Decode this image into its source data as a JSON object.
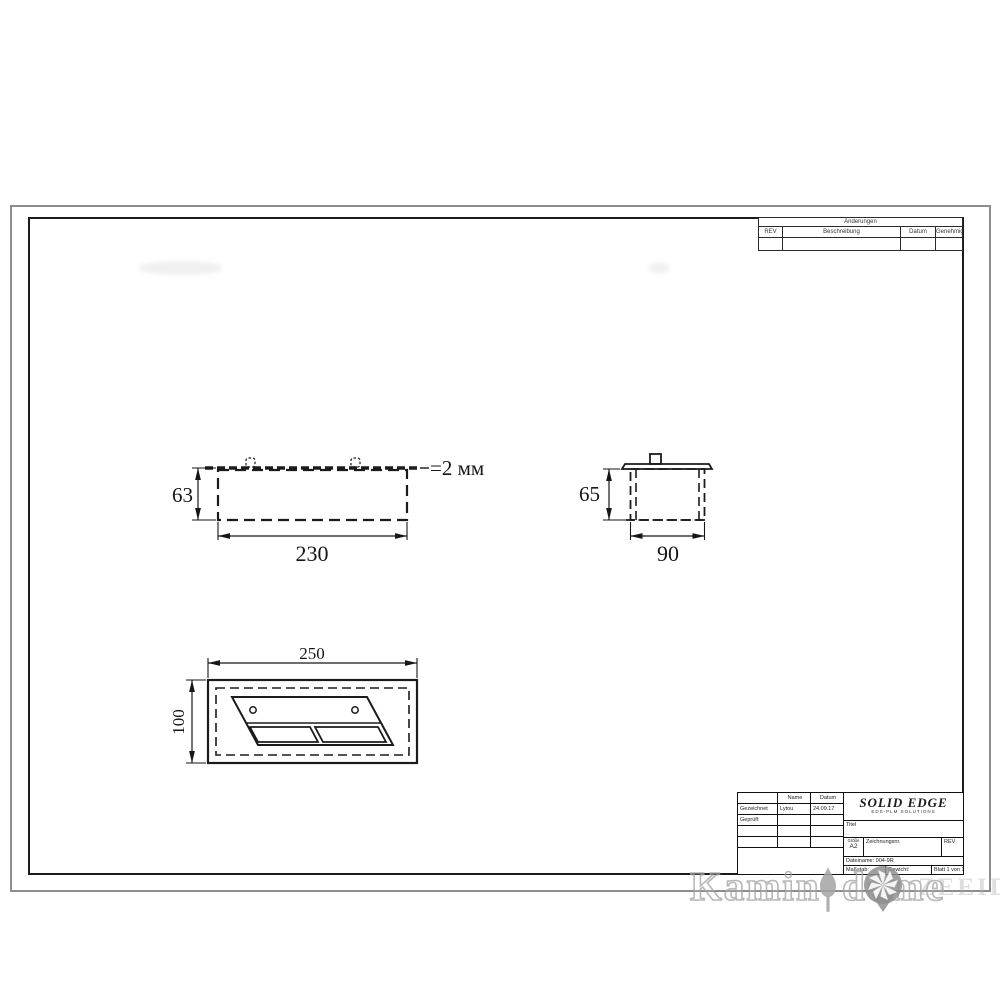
{
  "sheet": {
    "background": "#ffffff",
    "outer_border_color": "#8d8d8d",
    "frame_color": "#1b1b1b"
  },
  "revision_table": {
    "title": "Änderungen",
    "columns": [
      "REV",
      "Beschreibung",
      "Datum",
      "Genehmigt"
    ]
  },
  "views": {
    "front": {
      "height_dim": "63",
      "width_dim": "230",
      "thickness_note": "=2 мм"
    },
    "side": {
      "height_dim": "65",
      "width_dim": "90"
    },
    "top": {
      "width_dim": "250",
      "height_dim": "100"
    }
  },
  "title_block": {
    "name_header": "Name",
    "date_header": "Datum",
    "drawn_label": "Gezeichnet",
    "drawn_name": "Lytou",
    "drawn_date": "24.09.17",
    "checked_label": "Geprüft",
    "logo_title": "SOLID EDGE",
    "logo_subtitle": "EDS-PLM SOLUTIONS",
    "title_field_label": "Titel",
    "size_label": "Größe",
    "size_value": "A2",
    "drawing_number_label": "Zeichnungsnr.",
    "rev_label": "REV",
    "filename_text": "Dateiname: 004-9R",
    "scale_label": "Maßstab:",
    "weight_label": "Gewicht:",
    "sheet_text": "Blatt 1 von 1"
  },
  "watermark": {
    "word1": "Kamin",
    "word2": "dome",
    "faint_tail": "ZEEIDE"
  }
}
